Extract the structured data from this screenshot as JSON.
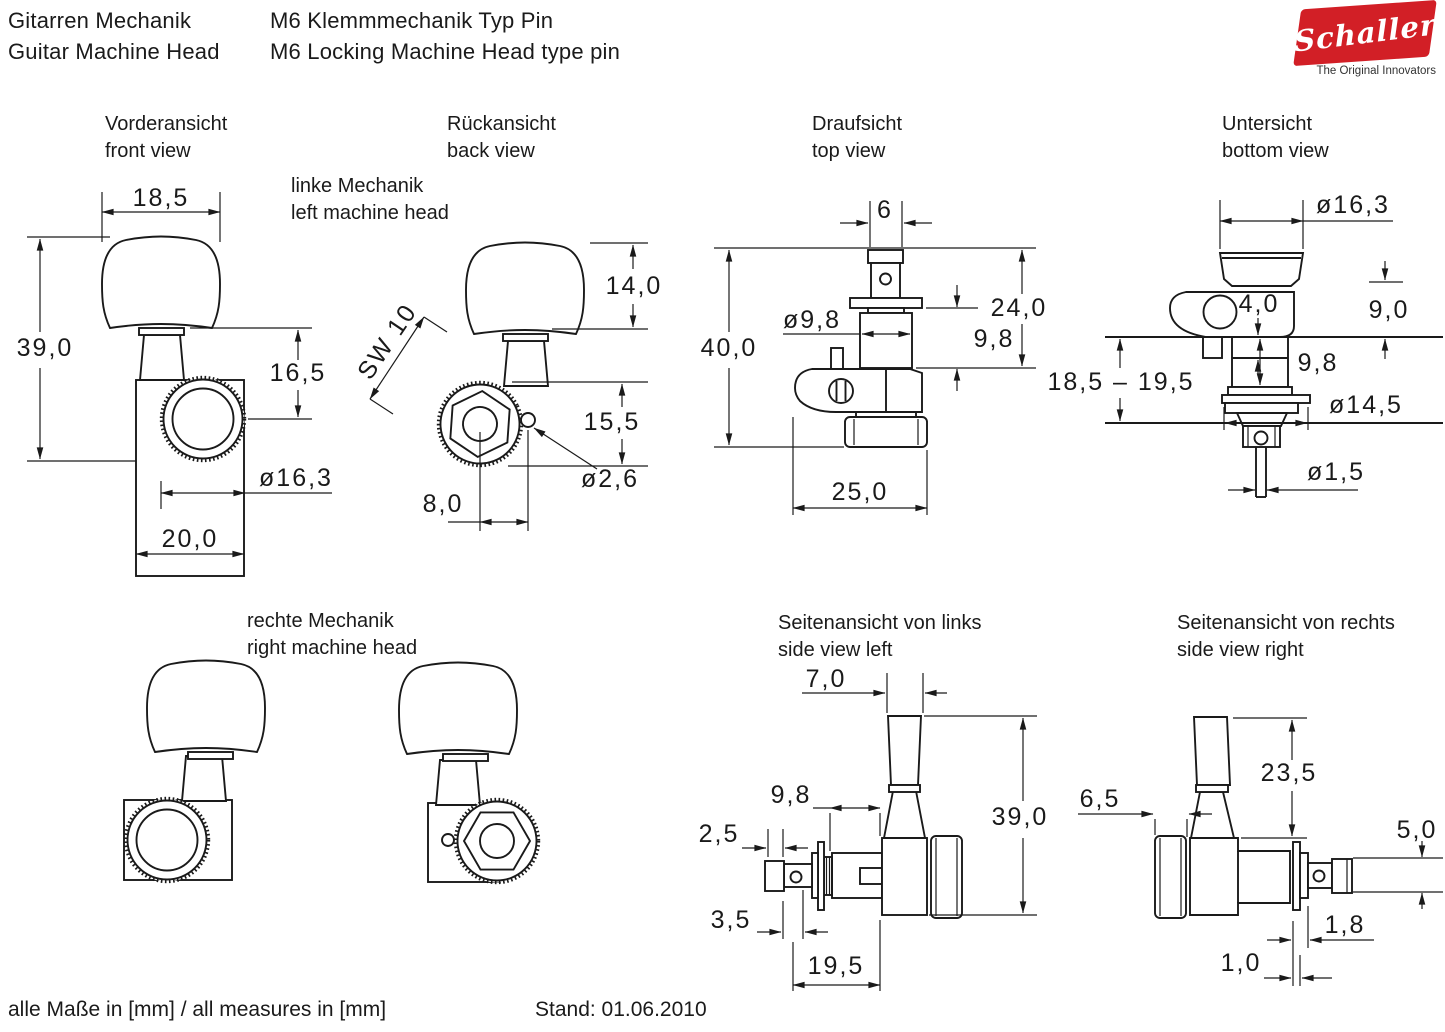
{
  "header": {
    "product_line_de": "Gitarren Mechanik",
    "product_line_en": "Guitar Machine Head",
    "model_de": "M6 Klemmmechanik Typ Pin",
    "model_en": "M6 Locking Machine Head type pin"
  },
  "logo": {
    "brand": "Schaller",
    "tagline": "The Original Innovators",
    "red": "#d21f26"
  },
  "views": {
    "front": {
      "title_de": "Vorderansicht",
      "title_en": "front view",
      "dims": {
        "button_width": "18,5",
        "total_height": "39,0",
        "post_offset": "16,5",
        "knob_dia": "ø16,3",
        "housing_width": "20,0"
      }
    },
    "back": {
      "title_de": "Rückansicht",
      "title_en": "back view",
      "dims": {
        "wrench_size": "SW 10",
        "button_height": "14,0",
        "knob_height": "15,5",
        "pin_hole_dia": "ø2,6",
        "pin_offset": "8,0"
      }
    },
    "top": {
      "title_de": "Draufsicht",
      "title_en": "top view",
      "dims": {
        "post_width": "6",
        "total_depth": "40,0",
        "bushing_dia": "ø9,8",
        "upper_depth": "24,0",
        "bushing_length": "9,8",
        "housing_depth": "25,0"
      }
    },
    "bottom": {
      "title_de": "Untersicht",
      "title_en": "bottom view",
      "dims": {
        "button_dia": "ø16,3",
        "plate_step": "4,0",
        "button_clearance": "9,0",
        "bushing_length": "9,8",
        "flange_dia": "ø14,5",
        "pin_dia": "ø1,5"
      }
    },
    "headstock_thickness_range": "18,5 – 19,5",
    "left_head": {
      "label_de": "linke Mechanik",
      "label_en": "left machine head"
    },
    "right_head": {
      "label_de": "rechte Mechanik",
      "label_en": "right machine head"
    },
    "side_left": {
      "title_de": "Seitenansicht von links",
      "title_en": "side view left",
      "dims": {
        "button_depth": "7,0",
        "bushing_length": "9,8",
        "tip_length": "2,5",
        "hole_offset": "3,5",
        "post_length": "19,5",
        "total_height": "39,0"
      }
    },
    "side_right": {
      "title_de": "Seitenansicht von rechts",
      "title_en": "side view right",
      "dims": {
        "knob_depth": "6,5",
        "upper_height": "23,5",
        "tip_dia": "5,0",
        "plate_washer": "1,8",
        "washer": "1,0"
      }
    }
  },
  "footer": {
    "measures_note": "alle Maße in [mm] / all measures in [mm]",
    "revision": "Stand: 01.06.2010"
  },
  "colors": {
    "line": "#1a1a1a",
    "background": "#ffffff",
    "logo_red": "#d21f26"
  }
}
